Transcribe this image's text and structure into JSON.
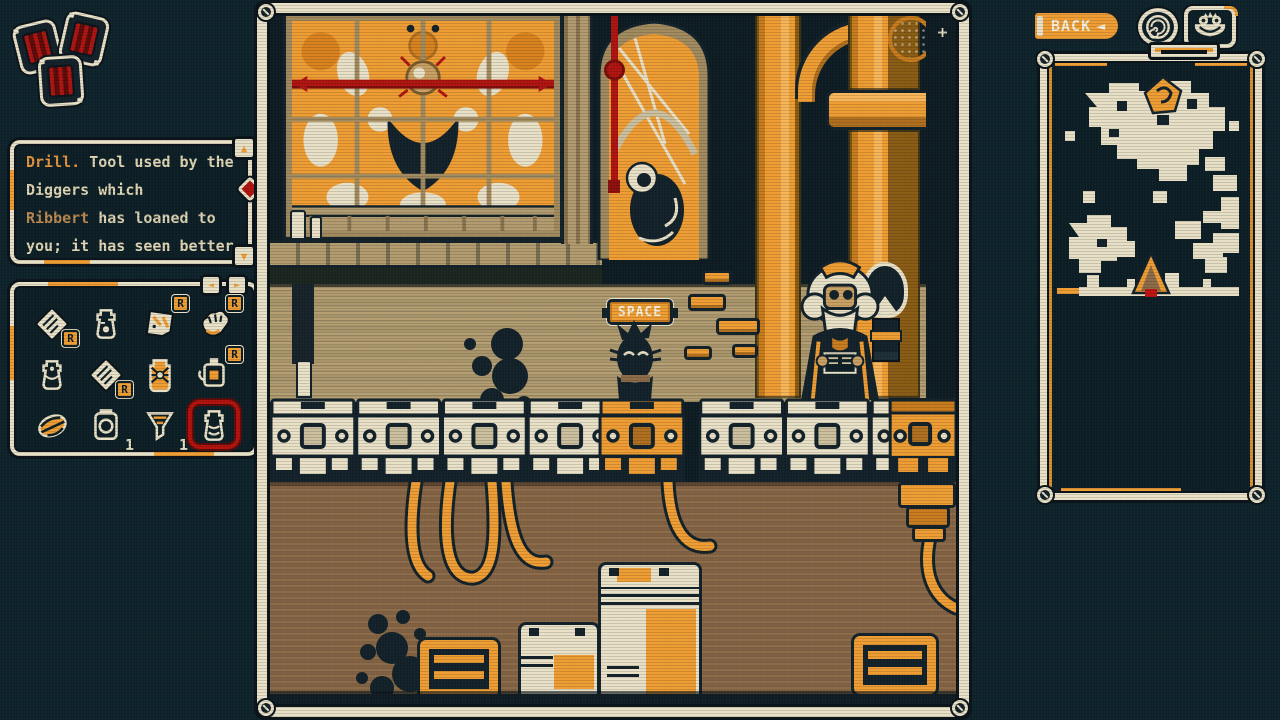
{
  "colors": {
    "background": "#0e232b",
    "panel": "#0d1f26",
    "cream": "#e9e1c7",
    "orange": "#ef9d33",
    "orange_dark": "#c97c1d",
    "tan_wall": "#b49e72",
    "window_frame": "#a18a5e",
    "dirt_brown": "#8d6b49",
    "red": "#b01410",
    "selection_red": "#b3120d",
    "outline": "#13222a",
    "text_cream": "#ded5b4",
    "text_orange": "#e2933c",
    "text_name": "#bd8a50"
  },
  "hud": {
    "back": {
      "label": "BACK",
      "arrow": "◄",
      "coil_icon": "coil",
      "portrait_icon": "frog-face"
    },
    "tokens": {
      "icon": "striped-card-token",
      "count": 3
    },
    "textbox": {
      "seg_item": "Drill.",
      "seg_l1": " Tool used by the",
      "seg_l2": "Diggers which",
      "seg_name": "Ribbert",
      "seg_l3": " has loaned to",
      "seg_l4": "you; it has seen better",
      "seg_l5": "days...",
      "scroll_up": "▲",
      "scroll_down": "▼",
      "gem_icon": "red-gem"
    },
    "inventory": {
      "prev": "◄",
      "next": "►",
      "items": [
        {
          "id": "letter-card",
          "badge": "R"
        },
        {
          "id": "clay-pot"
        },
        {
          "id": "map-scrap",
          "badge": "R"
        },
        {
          "id": "gloves",
          "badge": "R"
        },
        {
          "id": "clay-pot-2"
        },
        {
          "id": "letter-card-2",
          "badge": "R"
        },
        {
          "id": "ornate-pot"
        },
        {
          "id": "lantern",
          "badge": "R"
        },
        {
          "id": "shell"
        },
        {
          "id": "canister",
          "count": "1"
        },
        {
          "id": "drill-bit",
          "count": "1"
        },
        {
          "id": "drill",
          "selected": true
        }
      ]
    }
  },
  "game": {
    "space_prompt": "SPACE",
    "entities": {
      "player": "frog-adventurer",
      "npc": "elder-digger",
      "prompt_sign": "interact-sign",
      "lamp": "dome-lamp"
    }
  },
  "map_panel": {
    "markers": {
      "poi": "gem",
      "player": "dig-site"
    }
  }
}
